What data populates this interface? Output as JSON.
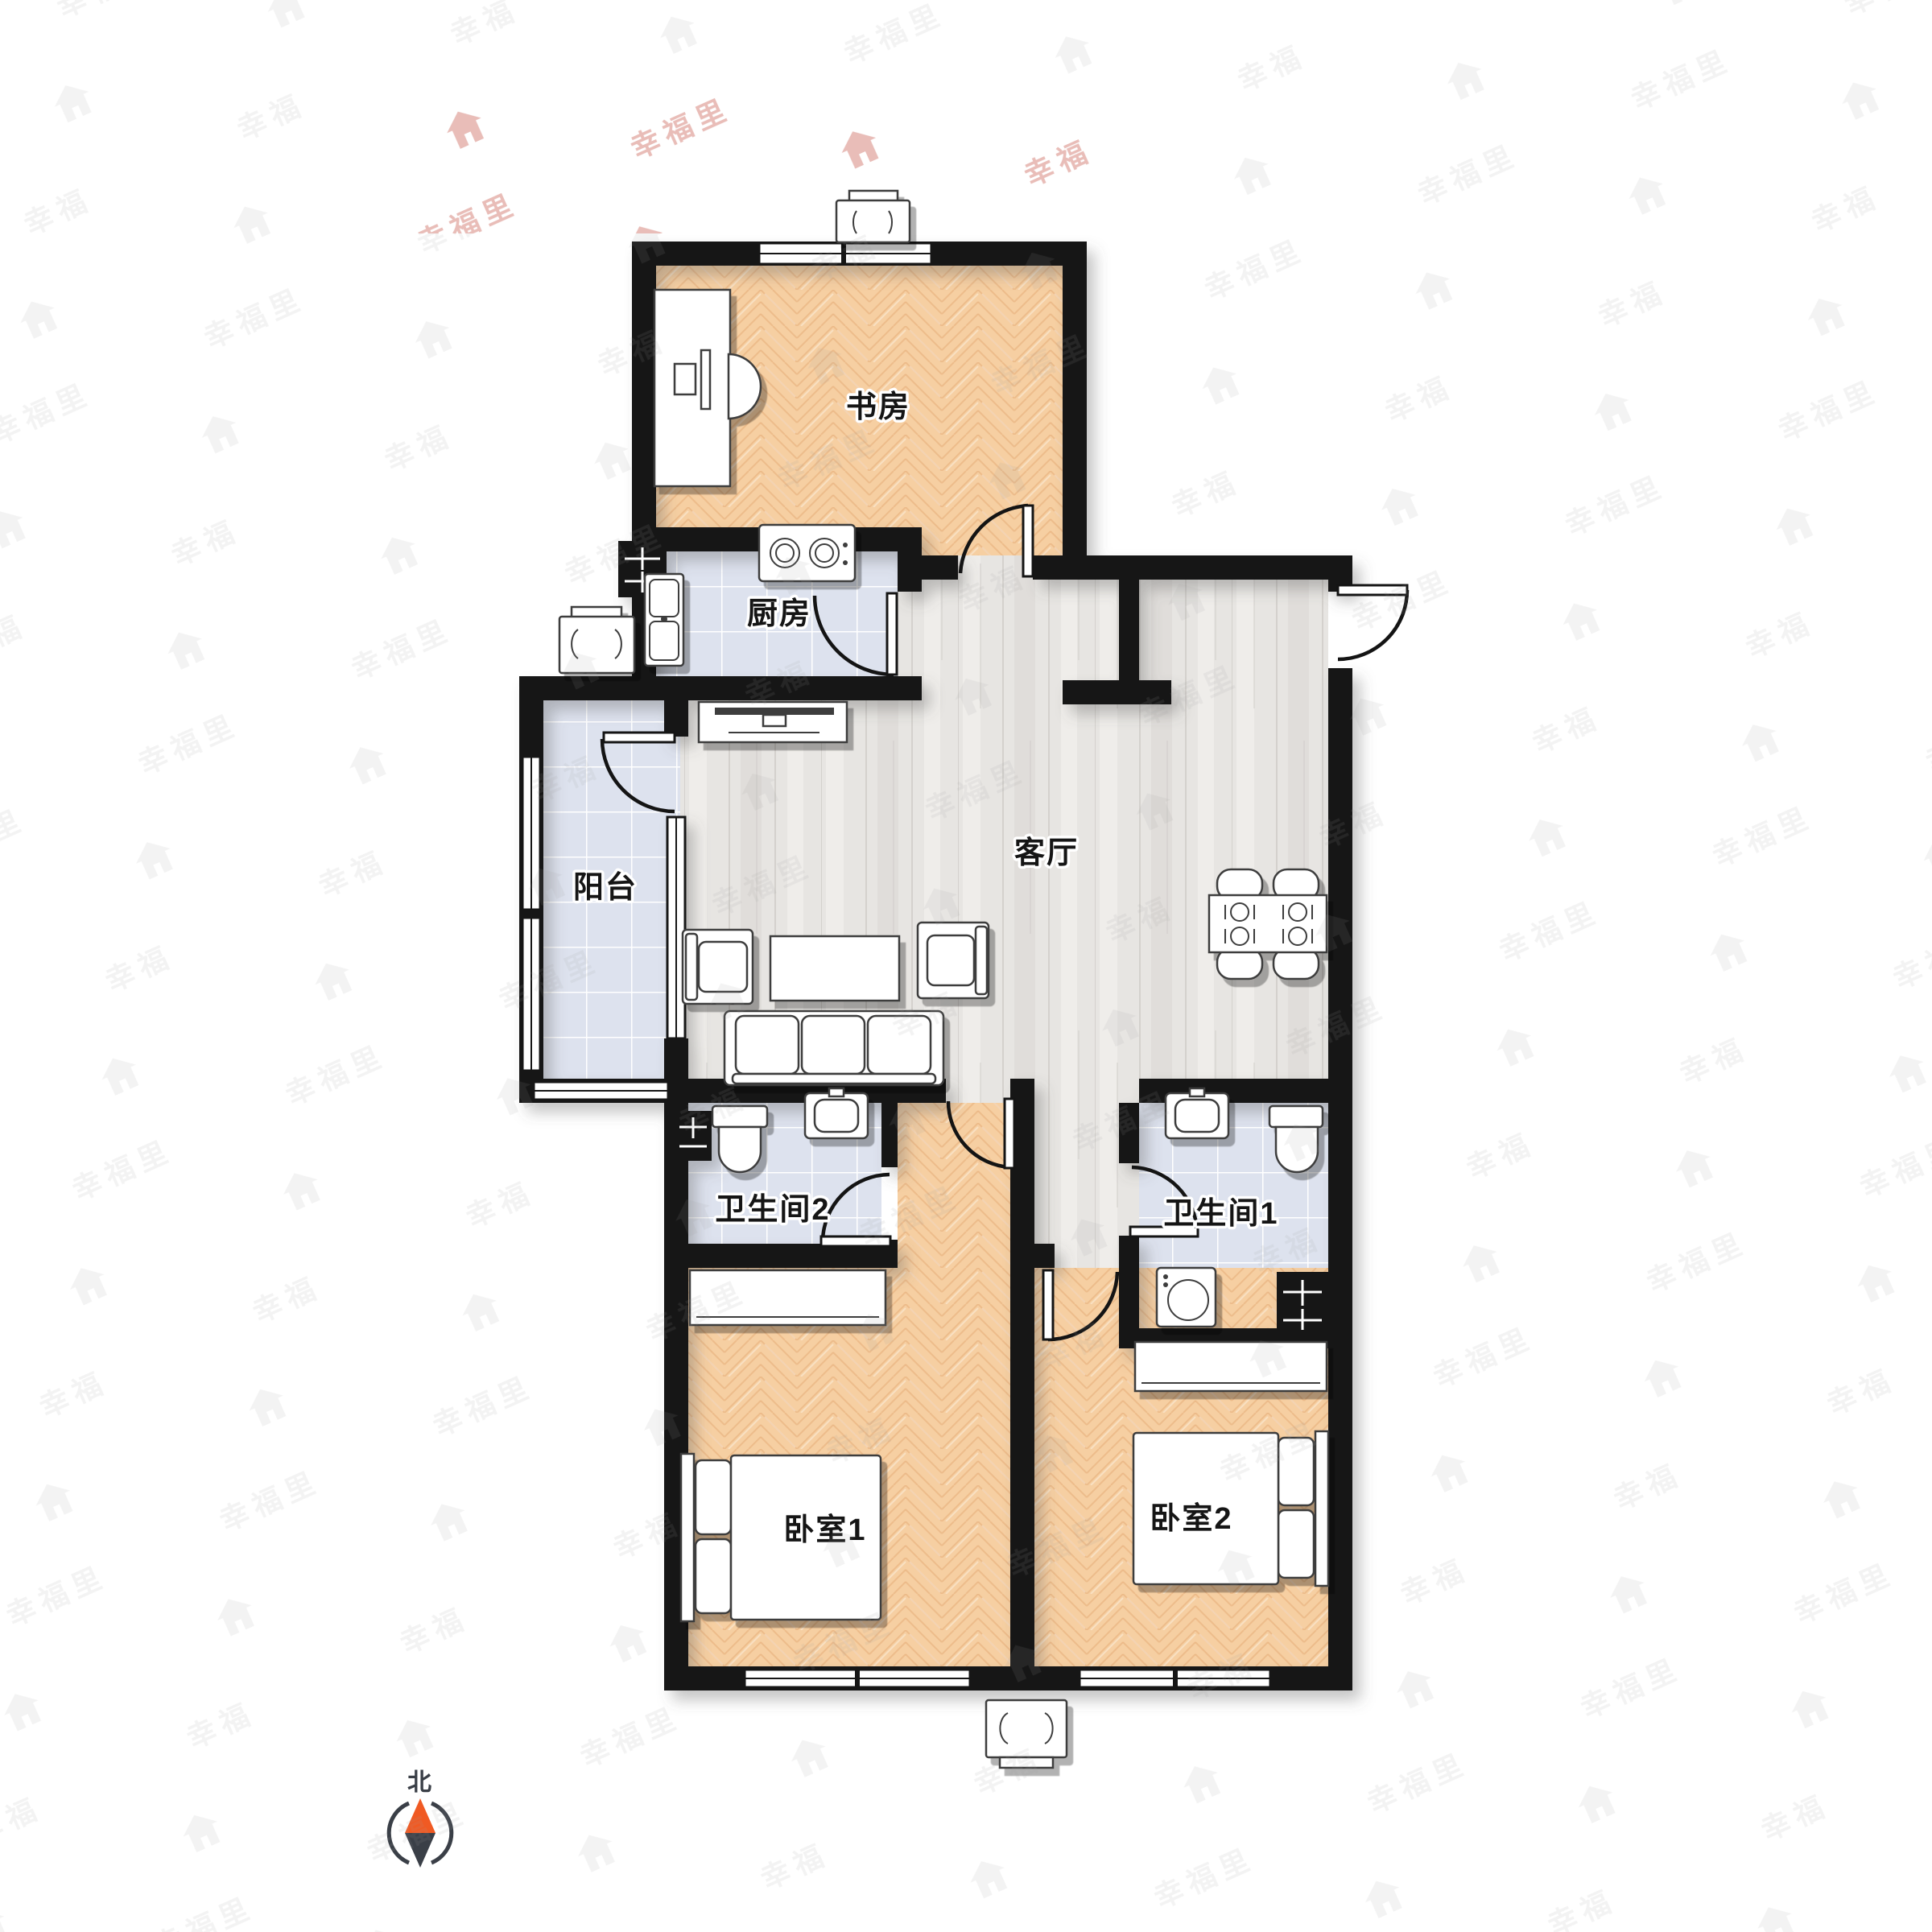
{
  "watermark": {
    "brand": "幸福里"
  },
  "compass": {
    "north_label": "北"
  },
  "rooms": [
    {
      "id": "study",
      "label": "书房"
    },
    {
      "id": "kitchen",
      "label": "厨房"
    },
    {
      "id": "living",
      "label": "客厅"
    },
    {
      "id": "balcony",
      "label": "阳台"
    },
    {
      "id": "bathroom2",
      "label": "卫生间2"
    },
    {
      "id": "bathroom1",
      "label": "卫生间1"
    },
    {
      "id": "bedroom1",
      "label": "卧室1"
    },
    {
      "id": "bedroom2",
      "label": "卧室2"
    }
  ],
  "colors": {
    "wall": "#161616",
    "wood_floor": "#f6cfa2",
    "tile_floor": "#dde2ee",
    "plank_floor": "#e7e5e2",
    "furniture_outline": "#3c3c3c",
    "compass_north": "#f05a23",
    "compass_south": "#3a3f47",
    "watermark_gray": "#e9e9e9",
    "watermark_red": "#e8b7b0"
  }
}
